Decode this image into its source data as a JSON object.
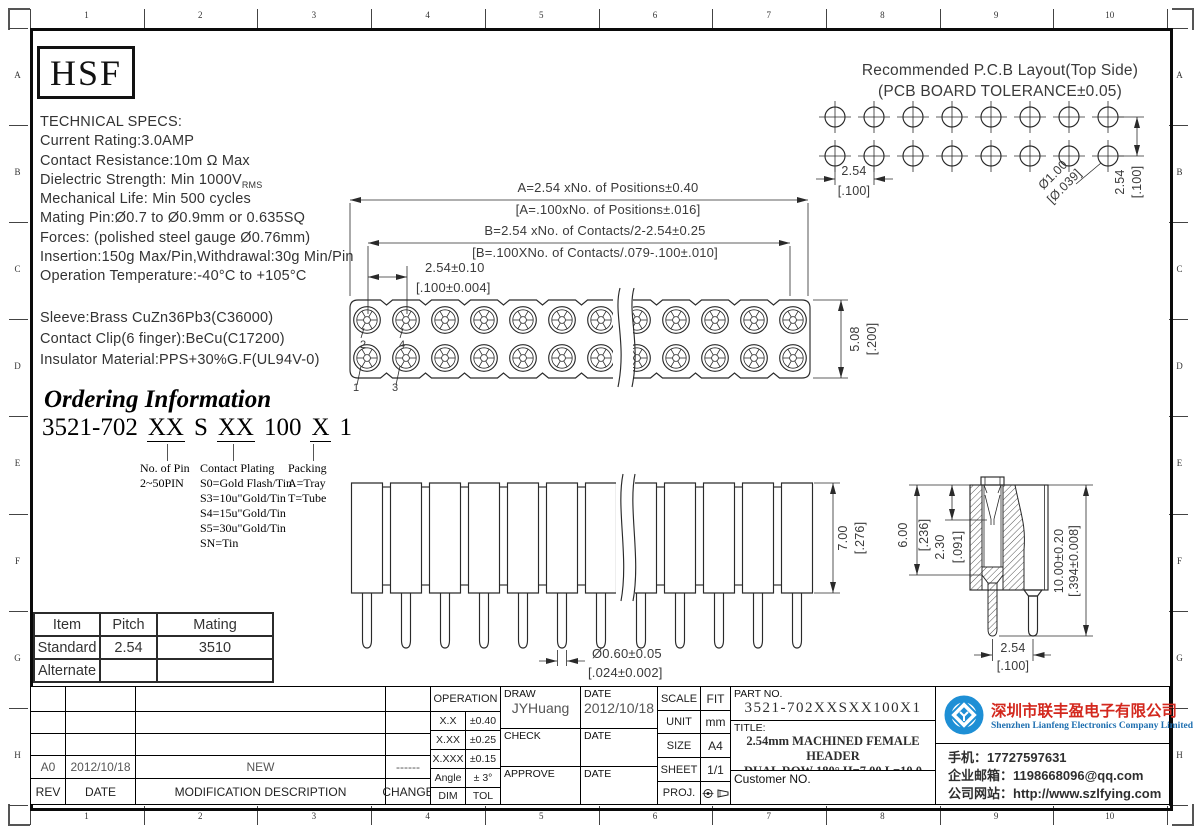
{
  "ruler": {
    "cols": [
      "1",
      "2",
      "3",
      "4",
      "5",
      "6",
      "7",
      "8",
      "9",
      "10"
    ],
    "rows": [
      "A",
      "B",
      "C",
      "D",
      "E",
      "F",
      "G",
      "H"
    ]
  },
  "logo": "HSF",
  "tech_specs": {
    "l0": "TECHNICAL SPECS:",
    "l1": "Current Rating:3.0AMP",
    "l2": "Contact Resistance:10m Ω Max",
    "dielectric_pre": "Dielectric Strength: Min 1000V",
    "dielectric_sub": "RMS",
    "l4": "Mechanical Life: Min 500 cycles",
    "l5": "Mating Pin:Ø0.7 to Ø0.9mm or 0.635SQ",
    "l6": "Forces: (polished steel gauge Ø0.76mm)",
    "l7": "Insertion:150g Max/Pin,Withdrawal:30g Min/Pin",
    "l8": "Operation Temperature:-40°C to +105°C"
  },
  "materials": {
    "l0": "Sleeve:Brass CuZn36Pb3(C36000)",
    "l1": "Contact Clip(6 finger):BeCu(C17200)",
    "l2": "Insulator Material:PPS+30%G.F(UL94V-0)"
  },
  "ordering": {
    "title": "Ordering Information",
    "c1": "3521-702",
    "c2": "XX",
    "c3": "S",
    "c4": "XX",
    "c5": "100",
    "c6": "X",
    "c7": "1",
    "pin_title": "No. of Pin",
    "pin_line": "2~50PIN",
    "plating_title": "Contact Plating",
    "p0": "S0=Gold Flash/Tin",
    "p1": "S3=10u\"Gold/Tin",
    "p2": "S4=15u\"Gold/Tin",
    "p3": "S5=30u\"Gold/Tin",
    "p4": "SN=Tin",
    "packing_title": "Packing",
    "k0": "A=Tray",
    "k1": "T=Tube"
  },
  "pcb": {
    "title1": "Recommended P.C.B Layout(Top Side)",
    "title2": "(PCB BOARD TOLERANCE±0.05)",
    "pitch_h": "2.54",
    "pitch_h_in": "[.100]",
    "hole": "Ø1.00",
    "hole_in": "[Ø.039]",
    "pitch_v": "2.54",
    "pitch_v_in": "[.100]"
  },
  "top_view": {
    "a1": "A=2.54 xNo. of Positions±0.40",
    "a2": "[A=.100xNo. of Positions±.016]",
    "b1": "B=2.54 xNo. of Contacts/2-2.54±0.25",
    "b2": "[B=.100XNo. of Contacts/.079-.100±.010]",
    "p1": "2.54±0.10",
    "p2": "[.100±0.004]",
    "h1": "5.08",
    "h2": "[.200]",
    "pin1": "1",
    "pin2": "2",
    "pin3": "3",
    "pin4": "4"
  },
  "side_view": {
    "h1": "7.00",
    "h2": "[.276]",
    "pin1": "Ø0.60±0.05",
    "pin2": "[.024±0.002]"
  },
  "section_view": {
    "d1a": "6.00",
    "d1b": "[.236]",
    "d2a": "2.30",
    "d2b": "[.091]",
    "d3a": "10.00±0.20",
    "d3b": "[.394±0.008]",
    "d4a": "2.54",
    "d4b": "[.100]"
  },
  "mating_table": {
    "h0": "Item",
    "h1": "Pitch",
    "h2": "Mating",
    "r1c0": "Standard",
    "r1c1": "2.54",
    "r1c2": "3510",
    "r2c0": "Alternate",
    "r2c1": "",
    "r2c2": ""
  },
  "revision": {
    "rev": "A0",
    "date": "2012/10/18",
    "desc": "NEW",
    "change": "------",
    "h_rev": "REV",
    "h_date": "DATE",
    "h_desc": "MODIFICATION DESCRIPTION",
    "h_change": "CHANGE"
  },
  "tolerance": {
    "header": "OPERATION",
    "r1l": "X.X",
    "r1v": "±0.40",
    "r2l": "X.XX",
    "r2v": "±0.25",
    "r3l": "X.XXX",
    "r3v": "±0.15",
    "r4l": "Angle",
    "r4v": "± 3°",
    "r5l": "DIM",
    "r5v": "TOL"
  },
  "sign": {
    "draw_l": "DRAW",
    "date_l": "DATE",
    "check_l": "CHECK",
    "approve_l": "APPROVE",
    "draw_name": "JYHuang",
    "draw_date": "2012/10/18"
  },
  "info": {
    "scale_l": "SCALE",
    "scale": "FIT",
    "unit_l": "UNIT",
    "unit": "mm",
    "size_l": "SIZE",
    "size": "A4",
    "sheet_l": "SHEET",
    "sheet": "1/1",
    "proj_l": "PROJ."
  },
  "part": {
    "no_label": "PART NO.",
    "no": "3521-702XXSXX100X1",
    "title_label": "TITLE:",
    "t1": "2.54mm MACHINED FEMALE HEADER",
    "t2": "DUAL ROW 180° H=7.00 L=10.0",
    "customer": "Customer NO."
  },
  "company": {
    "cn": "深圳市联丰盈电子有限公司",
    "en": "Shenzhen Lianfeng Electronics Company Limited",
    "phone": "手机：17727597631",
    "email": "企业邮箱：1198668096@qq.com",
    "web": "公司网站：http://www.szlfying.com",
    "accent_blue": "#1e8fd5",
    "brand_red": "#d3281e"
  }
}
